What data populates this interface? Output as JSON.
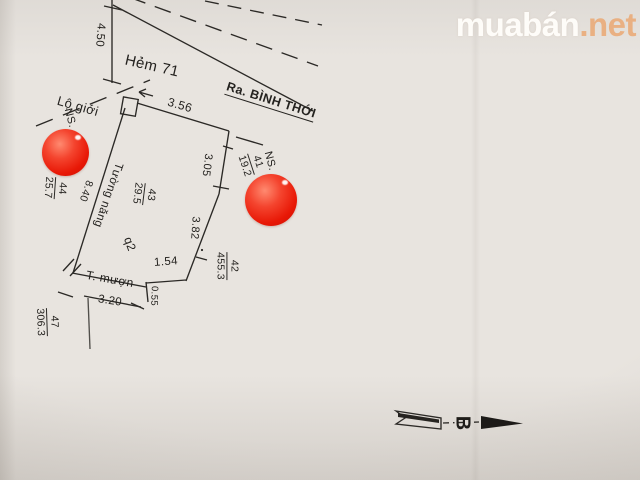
{
  "watermark": {
    "brand": "muabán",
    "suffix": ".net"
  },
  "drawing": {
    "street_labels": {
      "alley": "Hẻm 71",
      "direction": "Ra. BÌNH THỚI",
      "road_boundary": "Lộ giới"
    },
    "annotations": {
      "ns_left": "NS.",
      "ns_right": "NS.",
      "wall_left": "Tường năng",
      "wall_left_length": "8.40",
      "wall_bottom": "T. mượn",
      "block": "q2"
    },
    "dimensions": {
      "alley_width": "4.50",
      "front": "3.56",
      "right_upper": "3.05",
      "right_lower": "3.82",
      "rear_right": "1.54",
      "step": "0.55",
      "rear_front": "3.20"
    },
    "parcels": {
      "p44": {
        "number": "44",
        "area": "25.7"
      },
      "p43": {
        "number": "43",
        "area": "29.5"
      },
      "p41": {
        "number": "41",
        "area": "19.2"
      },
      "p42": {
        "number": "42",
        "area": "455.3"
      },
      "p47": {
        "number": "47",
        "area": "306.3"
      }
    },
    "compass": {
      "north": "B"
    }
  },
  "colors": {
    "paper": "#e8e4df",
    "ink": "#2b2926",
    "sticker_red": "#ef2c12",
    "watermark_accent": "#eb9a5e"
  }
}
